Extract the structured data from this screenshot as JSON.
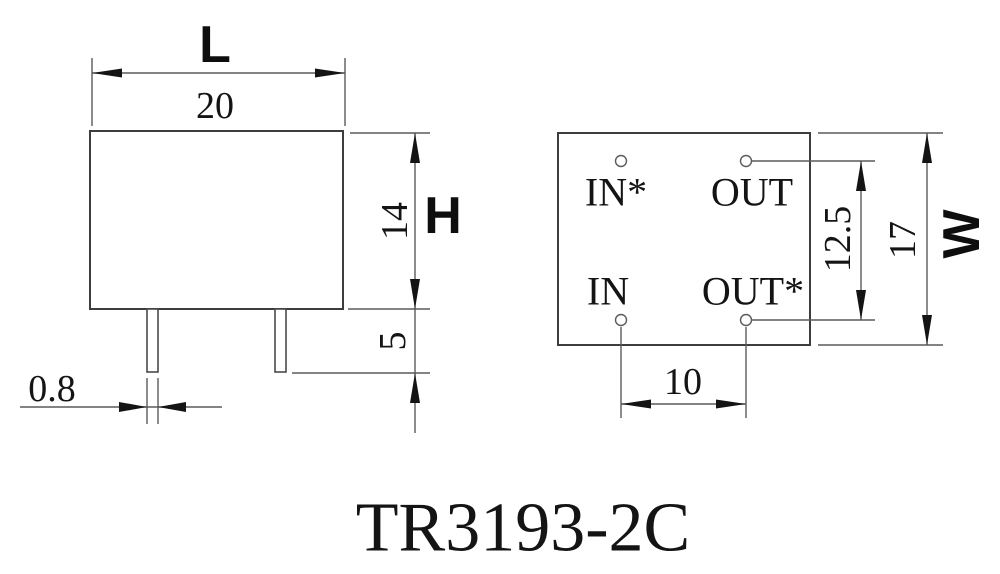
{
  "drawing": {
    "title": "TR3193-2C",
    "side_view": {
      "length_symbol": "L",
      "length_value": "20",
      "height_symbol": "H",
      "body_height_value": "14",
      "pin_length_value": "5",
      "pin_width_value": "0.8"
    },
    "top_view": {
      "pins": [
        {
          "label": "IN*"
        },
        {
          "label": "OUT"
        },
        {
          "label": "IN"
        },
        {
          "label": "OUT*"
        }
      ],
      "width_symbol": "W",
      "width_value": "17",
      "pin_row_spacing_value": "12.5",
      "pin_col_spacing_value": "10"
    },
    "colors": {
      "background": "#ffffff",
      "line": "#5a5a5a",
      "ink": "#141414"
    }
  }
}
